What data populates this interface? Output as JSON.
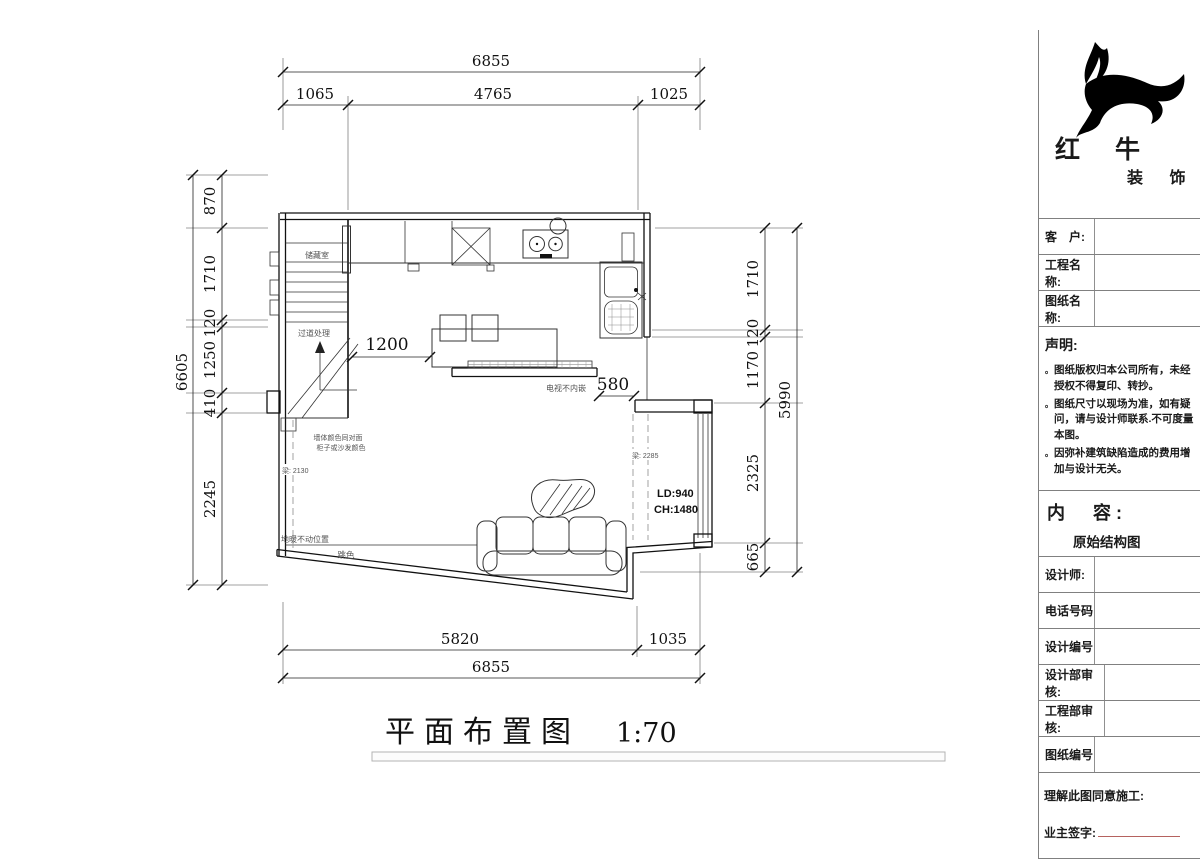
{
  "drawing": {
    "plan_title": "平面布置图",
    "scale": "1:70",
    "dims": {
      "top_overall": "6855",
      "top_segments": [
        "1065",
        "4765",
        "1025"
      ],
      "bottom_segments": [
        "5820",
        "1035"
      ],
      "bottom_overall": "6855",
      "left_overall": "6605",
      "left_segments": [
        "870",
        "1710",
        "120",
        "1250",
        "410",
        "2245"
      ],
      "right_segments": [
        "1710",
        "120",
        "1170",
        "2325",
        "665"
      ],
      "right_overall": "5990",
      "walkway": "1200",
      "opening": "580"
    },
    "labels": {
      "storage_room": "储藏室",
      "corridor_note": "过道处理",
      "tv_note": "电视不内嵌",
      "wall_color_note_1": "墙体颜色同对面",
      "wall_color_note_2": "柜子或沙发颜色",
      "beam_left": "梁: 2130",
      "beam_right": "梁: 2285",
      "floor_note": "地暖不动位置",
      "tile_color_note": "跳色",
      "window_ld": "LD:940",
      "window_ch": "CH:1480"
    }
  },
  "title_block": {
    "brand_main": "红 牛",
    "brand_sub": "装 饰",
    "fields_top": [
      {
        "label": "客　户:"
      },
      {
        "label": "工程名称:"
      },
      {
        "label": "图纸名称:"
      }
    ],
    "statement": {
      "heading": "声明:",
      "bullet": "。",
      "items": [
        "图纸版权归本公司所有，未经授权不得复印、转抄。",
        "图纸尺寸以现场为准，如有疑问，请与设计师联系.不可度量本图。",
        "因弥补建筑缺陷造成的费用增加与设计无关。"
      ]
    },
    "content": {
      "label": "内　容:",
      "value": "原始结构图"
    },
    "fields_bottom": [
      {
        "label": "设计师:"
      },
      {
        "label": "电话号码"
      },
      {
        "label": "设计编号"
      },
      {
        "label": "设计部审核:"
      },
      {
        "label": "工程部审核:"
      },
      {
        "label": "图纸编号"
      }
    ],
    "footer": {
      "agree": "理解此图同意施工:",
      "sign": "业主签字:"
    }
  }
}
